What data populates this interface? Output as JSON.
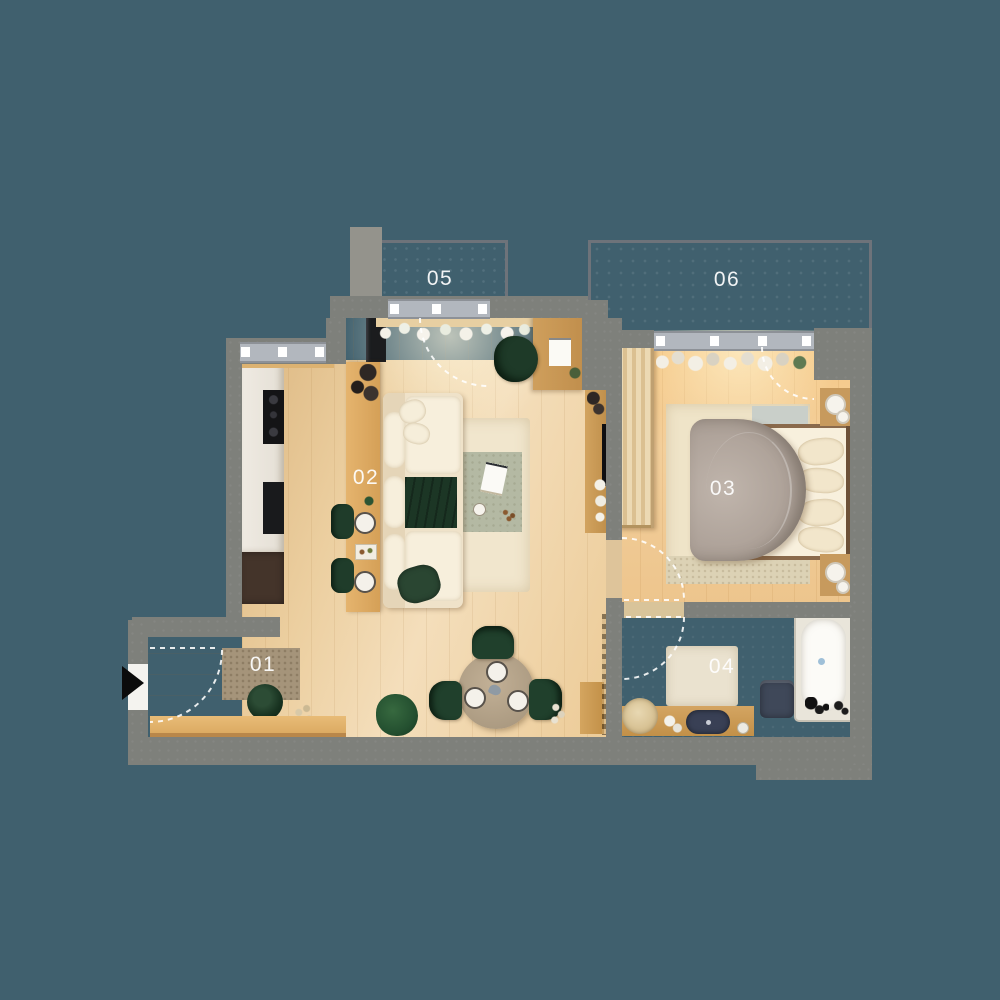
{
  "plan": {
    "type": "apartment-floor-plan-top-view",
    "rooms": [
      {
        "label": "01",
        "kind": "entry-hall"
      },
      {
        "label": "02",
        "kind": "living-room-with-kitchen"
      },
      {
        "label": "03",
        "kind": "bedroom"
      },
      {
        "label": "04",
        "kind": "bathroom"
      },
      {
        "label": "05",
        "kind": "balcony"
      },
      {
        "label": "06",
        "kind": "balcony"
      }
    ],
    "icons": {
      "entrance_arrow": "triangle-right",
      "door_swings": "dashed-quarter-arcs"
    },
    "colors": {
      "background": "#40606e",
      "wall": "#7e807b",
      "floor_wood": "#ecd0a2",
      "floor_wood_warm": "#f2c88d",
      "balcony_concrete": "#a9afb7",
      "bathroom_concrete": "#958d84",
      "accent_green": "#1e3b29",
      "textile_cream": "#f2e7cf",
      "duvet_taupe": "#b0a49b",
      "cabinet_dark": "#44342a",
      "navy_fixture": "#3c4357",
      "label_text": "#ffffff"
    }
  }
}
